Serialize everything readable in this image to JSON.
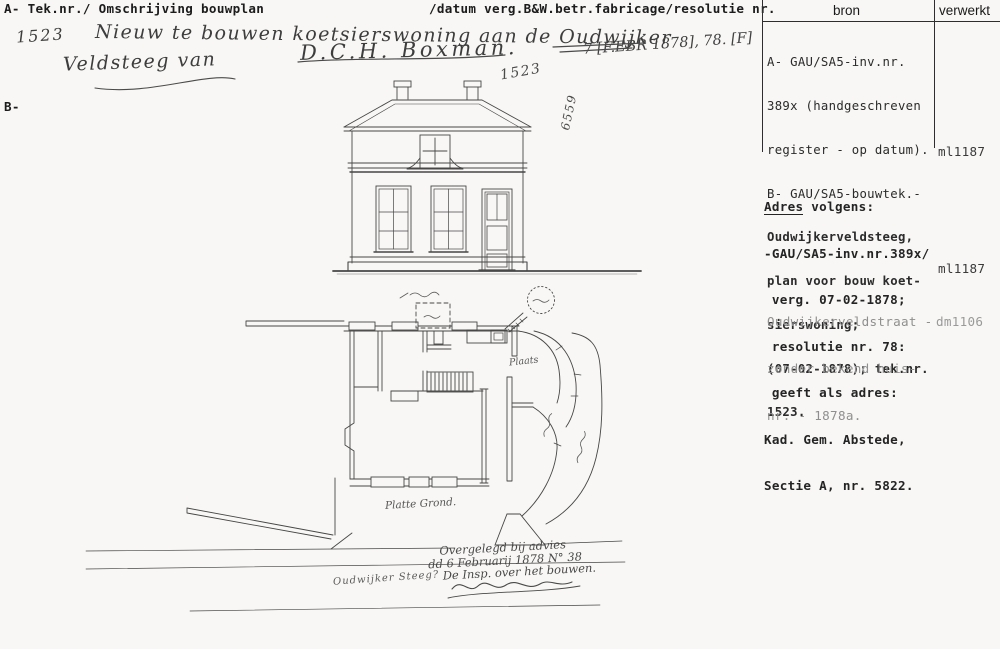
{
  "colors": {
    "paper": "#f8f7f5",
    "ink": "#2b2b2b",
    "faded_ink": "#8f8f8f",
    "drawing_line": "#474747",
    "handwriting_ink": "#4a4a4a"
  },
  "header": {
    "left": "A- Tek.nr./ Omschrijving bouwplan",
    "right": "/datum verg.B&W.betr.fabricage/resolutie nr.",
    "col_bron": "bron",
    "col_verwerkt": "verwerkt"
  },
  "margin": {
    "label": "B-"
  },
  "handwriting": {
    "tek_nr": "1523",
    "title_line1": "Nieuw te bouwen koetsierswoning aan de Oudwijker",
    "title_line2": "Veldsteeg van",
    "owner": "D.C.H. Boxman.",
    "date_stamp": "7 [F.EBR 1878], 78. [F]",
    "drawing_nr": "1523",
    "side_nr": "6559",
    "label_plaats": "Plaats",
    "label_plattegrond": "Platte Grond.",
    "label_steeg": "Oudwijker Steeg?",
    "approval_line1": "Overgelegd bij advies",
    "approval_line2": "dd 6 Februarij 1878 N° 38",
    "approval_line3": "De Insp. over het bouwen."
  },
  "bron": {
    "block_a": {
      "lines": [
        "A- GAU/SA5-inv.nr.",
        "389x (handgeschreven",
        "register - op datum).",
        "B- GAU/SA5-bouwtek.-",
        "Oudwijkerveldsteeg,",
        "plan voor bouw koet-",
        "sierswoning;",
        "(07-02-1878); tek.nr.",
        "1523."
      ],
      "verwerkt": "ml1187"
    },
    "block_b": {
      "title_word": "Adres",
      "title_rest": " volgens:",
      "lines": [
        "-GAU/SA5-inv.nr.389x/",
        " verg. 07-02-1878;",
        " resolutie nr. 78:",
        " geeft als adres:",
        "Kad. Gem. Abstede,",
        "Sectie A, nr. 5822."
      ],
      "verwerkt": "ml1187"
    },
    "block_c": {
      "lines": [
        "Oudwijkerveldstraat -",
        "zonder bekend huis-",
        "nr. - 1878a."
      ],
      "verwerkt": "dm1106"
    }
  }
}
